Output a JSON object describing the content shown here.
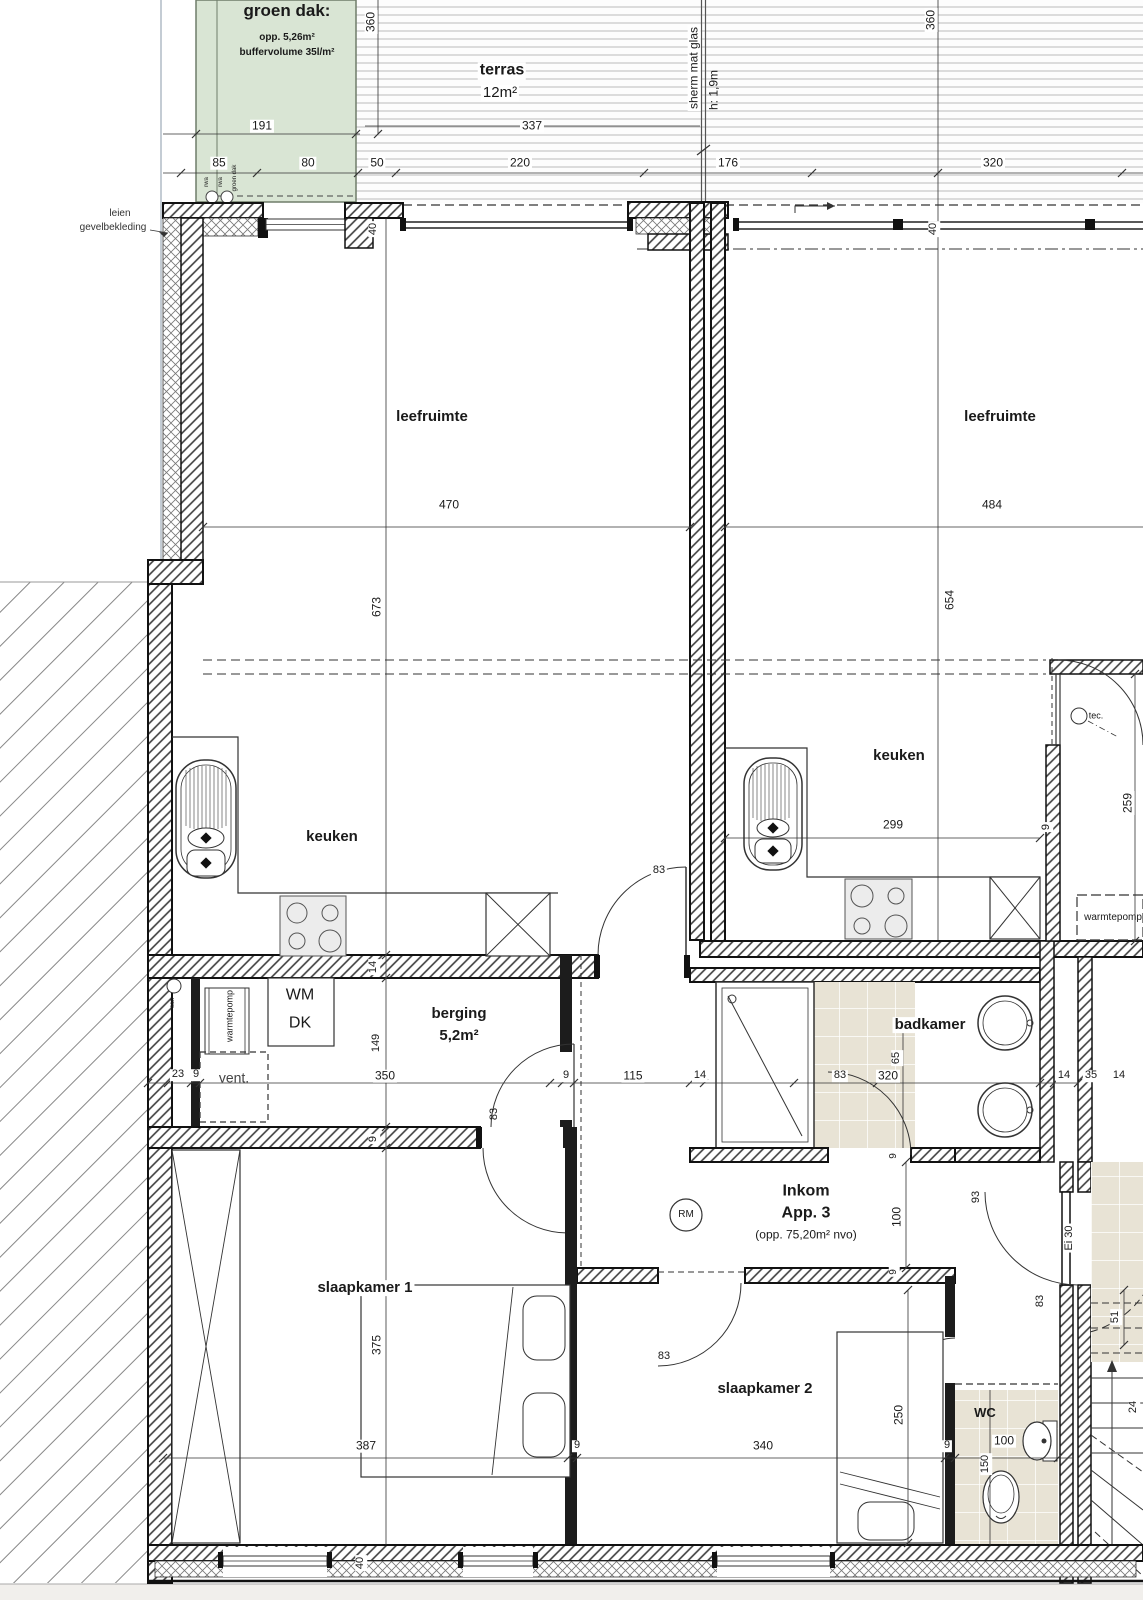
{
  "title": "floor plan apartment 3",
  "colors": {
    "green_roof": "#d9e5d4",
    "green_roof_border": "#6f7d6a",
    "tile_floor": "#e8e3d5",
    "wall_line": "#111111",
    "dim_line": "#333333",
    "page_margin": "#f1efec"
  },
  "rooms": {
    "groen_dak": {
      "title": "groen dak:",
      "line1": "opp. 5,26m²",
      "line2": "buffervolume 35l/m²"
    },
    "terras": {
      "title": "terras",
      "area": "12m²"
    },
    "leefruimte_left": "leefruimte",
    "leefruimte_right": "leefruimte",
    "keuken_left": "keuken",
    "keuken_right": "keuken",
    "berging": {
      "title": "berging",
      "area": "5,2m²"
    },
    "badkamer": "badkamer",
    "inkom": {
      "line1": "Inkom",
      "line2": "App. 3",
      "line3": "(opp. 75,20m² nvo)"
    },
    "slaapkamer1": "slaapkamer 1",
    "slaapkamer2": "slaapkamer 2",
    "wc": "WC",
    "tec": "tec.",
    "warmtepomp_right": "warmtepomp",
    "warmtepomp_left": "warmtepomp",
    "vent": "vent.",
    "san": "san",
    "wm": "WM",
    "dk": "DK",
    "rm": "RM",
    "ei30": "Ei 30"
  },
  "annotations": {
    "facade": [
      "leien",
      "gevelbekleding"
    ],
    "screen": [
      "sherm mat glas",
      "h: 1,9m"
    ],
    "roof_drains": [
      "rwa",
      "rwa",
      "groen dak"
    ]
  },
  "labels": [
    {
      "n": "room-groendak-title",
      "t": "groen dak:",
      "x": 287,
      "y": 11,
      "s": 17,
      "b": true
    },
    {
      "n": "room-groendak-opp",
      "t": "opp. 5,26m²",
      "x": 287,
      "y": 38,
      "s": 10,
      "b": true
    },
    {
      "n": "room-groendak-buffer",
      "t": "buffervolume 35l/m²",
      "x": 287,
      "y": 53,
      "s": 10,
      "b": true
    },
    {
      "n": "room-terras-title",
      "t": "terras",
      "x": 502,
      "y": 71,
      "s": 16,
      "b": true,
      "bg": true
    },
    {
      "n": "room-terras-area",
      "t": "12m²",
      "x": 500,
      "y": 93,
      "s": 15,
      "bg": true
    },
    {
      "n": "dim-191",
      "t": "191",
      "x": 262,
      "y": 126,
      "s": 12,
      "bg": true
    },
    {
      "n": "dim-360-left",
      "t": "360",
      "x": 371,
      "y": 22,
      "s": 12,
      "bg": true,
      "r": true
    },
    {
      "n": "dim-337",
      "t": "337",
      "x": 532,
      "y": 126,
      "s": 12,
      "bg": true
    },
    {
      "n": "note-sherm",
      "t": "sherm mat glas",
      "x": 694,
      "y": 68,
      "s": 12,
      "r": true,
      "bg": true
    },
    {
      "n": "note-sherm-h",
      "t": "h: 1,9m",
      "x": 714,
      "y": 90,
      "s": 12,
      "r": true
    },
    {
      "n": "dim-360-right",
      "t": "360",
      "x": 931,
      "y": 20,
      "s": 12,
      "bg": true,
      "r": true
    },
    {
      "n": "dim-85",
      "t": "85",
      "x": 219,
      "y": 163,
      "s": 12,
      "bg": true
    },
    {
      "n": "dim-80",
      "t": "80",
      "x": 308,
      "y": 163,
      "s": 12,
      "bg": true
    },
    {
      "n": "dim-50",
      "t": "50",
      "x": 377,
      "y": 163,
      "s": 12,
      "bg": true
    },
    {
      "n": "dim-220",
      "t": "220",
      "x": 520,
      "y": 163,
      "s": 12,
      "bg": true
    },
    {
      "n": "dim-176",
      "t": "176",
      "x": 728,
      "y": 163,
      "s": 12,
      "bg": true
    },
    {
      "n": "dim-320-terras",
      "t": "320",
      "x": 993,
      "y": 163,
      "s": 12,
      "bg": true
    },
    {
      "n": "note-rwa-1",
      "t": "rwa",
      "x": 207,
      "y": 182,
      "s": 6,
      "r": true
    },
    {
      "n": "note-rwa-2",
      "t": "rwa",
      "x": 221,
      "y": 182,
      "s": 6,
      "r": true
    },
    {
      "n": "note-rwa-groendak",
      "t": "groen dak",
      "x": 235,
      "y": 178,
      "s": 6,
      "r": true
    },
    {
      "n": "note-leien",
      "t": "leien",
      "x": 120,
      "y": 214,
      "s": 10,
      "c": "#333"
    },
    {
      "n": "note-gevelbekleding",
      "t": "gevelbekleding",
      "x": 113,
      "y": 228,
      "s": 10,
      "c": "#333"
    },
    {
      "n": "dim-40-topleft",
      "t": "40",
      "x": 374,
      "y": 229,
      "s": 11,
      "bg": true,
      "r": true
    },
    {
      "n": "dim-40-topright",
      "t": "40",
      "x": 934,
      "y": 229,
      "s": 11,
      "bg": true,
      "r": true
    },
    {
      "n": "room-leefruimte-left",
      "t": "leefruimte",
      "x": 432,
      "y": 417,
      "s": 15,
      "b": true
    },
    {
      "n": "room-leefruimte-right",
      "t": "leefruimte",
      "x": 1000,
      "y": 417,
      "s": 15,
      "b": true
    },
    {
      "n": "dim-470",
      "t": "470",
      "x": 449,
      "y": 505,
      "s": 12,
      "bg": true
    },
    {
      "n": "dim-484",
      "t": "484",
      "x": 992,
      "y": 505,
      "s": 12,
      "bg": true
    },
    {
      "n": "dim-673",
      "t": "673",
      "x": 377,
      "y": 607,
      "s": 12,
      "bg": true,
      "r": true
    },
    {
      "n": "dim-654",
      "t": "654",
      "x": 950,
      "y": 600,
      "s": 12,
      "bg": true,
      "r": true
    },
    {
      "n": "room-keuken-left",
      "t": "keuken",
      "x": 332,
      "y": 837,
      "s": 15,
      "b": true
    },
    {
      "n": "room-keuken-right",
      "t": "keuken",
      "x": 899,
      "y": 756,
      "s": 15,
      "b": true
    },
    {
      "n": "dim-299",
      "t": "299",
      "x": 893,
      "y": 825,
      "s": 12,
      "bg": true
    },
    {
      "n": "dim-9-keukenwall",
      "t": "9",
      "x": 1047,
      "y": 827,
      "s": 11,
      "bg": true,
      "r": true
    },
    {
      "n": "dim-259",
      "t": "259",
      "x": 1128,
      "y": 803,
      "s": 12,
      "bg": true,
      "r": true
    },
    {
      "n": "room-tec",
      "t": "tec.",
      "x": 1096,
      "y": 716,
      "s": 9
    },
    {
      "n": "room-warmtepomp-right",
      "t": "warmtepomp",
      "x": 1113,
      "y": 918,
      "s": 10
    },
    {
      "n": "dim-83-keukendoor",
      "t": "83",
      "x": 659,
      "y": 871,
      "s": 11,
      "bg": true
    },
    {
      "n": "dim-14-wall",
      "t": "14",
      "x": 374,
      "y": 967,
      "s": 11,
      "bg": true,
      "r": true
    },
    {
      "n": "note-wm",
      "t": "WM",
      "x": 300,
      "y": 996,
      "s": 16
    },
    {
      "n": "note-dk",
      "t": "DK",
      "x": 300,
      "y": 1024,
      "s": 16
    },
    {
      "n": "note-warmtepomp-left",
      "t": "warmtepomp",
      "x": 230,
      "y": 1016,
      "s": 9,
      "r": true
    },
    {
      "n": "note-vent",
      "t": "vent.",
      "x": 234,
      "y": 1078,
      "s": 14,
      "c": "#444"
    },
    {
      "n": "note-san",
      "t": "san",
      "x": 173,
      "y": 1003,
      "s": 6,
      "r": true
    },
    {
      "n": "room-berging-title",
      "t": "berging",
      "x": 459,
      "y": 1014,
      "s": 15,
      "b": true
    },
    {
      "n": "room-berging-area",
      "t": "5,2m²",
      "x": 459,
      "y": 1036,
      "s": 15,
      "b": true
    },
    {
      "n": "room-badkamer",
      "t": "badkamer",
      "x": 930,
      "y": 1025,
      "s": 15,
      "b": true,
      "bg": true
    },
    {
      "n": "dim-23",
      "t": "23",
      "x": 178,
      "y": 1075,
      "s": 11,
      "bg": true
    },
    {
      "n": "dim-9-a",
      "t": "9",
      "x": 196,
      "y": 1075,
      "s": 11,
      "bg": true
    },
    {
      "n": "dim-350",
      "t": "350",
      "x": 385,
      "y": 1076,
      "s": 12,
      "bg": true
    },
    {
      "n": "dim-149",
      "t": "149",
      "x": 377,
      "y": 1043,
      "s": 11,
      "bg": true,
      "r": true
    },
    {
      "n": "dim-9-b",
      "t": "9",
      "x": 566,
      "y": 1076,
      "s": 11,
      "bg": true
    },
    {
      "n": "dim-115",
      "t": "115",
      "x": 633,
      "y": 1076,
      "s": 12,
      "bg": true
    },
    {
      "n": "dim-14-b",
      "t": "14",
      "x": 700,
      "y": 1076,
      "s": 11,
      "bg": true
    },
    {
      "n": "dim-83-bad",
      "t": "83",
      "x": 840,
      "y": 1076,
      "s": 11,
      "bg": true
    },
    {
      "n": "dim-320-bad",
      "t": "320",
      "x": 888,
      "y": 1076,
      "s": 12,
      "bg": true
    },
    {
      "n": "dim-65",
      "t": "65",
      "x": 897,
      "y": 1058,
      "s": 11,
      "bg": true,
      "r": true
    },
    {
      "n": "dim-14-c",
      "t": "14",
      "x": 1064,
      "y": 1076,
      "s": 11,
      "bg": true
    },
    {
      "n": "dim-35",
      "t": "35",
      "x": 1091,
      "y": 1076,
      "s": 11,
      "bg": true
    },
    {
      "n": "dim-14-d",
      "t": "14",
      "x": 1119,
      "y": 1076,
      "s": 11,
      "bg": true
    },
    {
      "n": "dim-83-berging",
      "t": "83",
      "x": 495,
      "y": 1114,
      "s": 11,
      "r": true
    },
    {
      "n": "dim-9-c",
      "t": "9",
      "x": 374,
      "y": 1139,
      "s": 11,
      "bg": true,
      "r": true
    },
    {
      "n": "note-rm",
      "t": "RM",
      "x": 686,
      "y": 1215,
      "s": 10
    },
    {
      "n": "room-inkom-1",
      "t": "Inkom",
      "x": 806,
      "y": 1192,
      "s": 16,
      "b": true
    },
    {
      "n": "room-inkom-2",
      "t": "App. 3",
      "x": 806,
      "y": 1214,
      "s": 16,
      "b": true
    },
    {
      "n": "room-inkom-3",
      "t": "(opp. 75,20m² nvo)",
      "x": 806,
      "y": 1235,
      "s": 12
    },
    {
      "n": "dim-100-inkom",
      "t": "100",
      "x": 897,
      "y": 1217,
      "s": 12,
      "bg": true,
      "r": true
    },
    {
      "n": "dim-9-d",
      "t": "9",
      "x": 894,
      "y": 1156,
      "s": 10,
      "bg": true,
      "r": true
    },
    {
      "n": "dim-9-e",
      "t": "9",
      "x": 894,
      "y": 1272,
      "s": 10,
      "bg": true,
      "r": true
    },
    {
      "n": "dim-93",
      "t": "93",
      "x": 977,
      "y": 1197,
      "s": 11,
      "bg": true,
      "r": true
    },
    {
      "n": "note-ei30",
      "t": "Ei 30",
      "x": 1070,
      "y": 1238,
      "s": 11,
      "bg": true,
      "r": true
    },
    {
      "n": "dim-83-stair",
      "t": "83",
      "x": 1041,
      "y": 1301,
      "s": 11,
      "r": true
    },
    {
      "n": "dim-51",
      "t": "51",
      "x": 1116,
      "y": 1317,
      "s": 11,
      "bg": true,
      "r": true
    },
    {
      "n": "dim-24",
      "t": "24",
      "x": 1134,
      "y": 1407,
      "s": 11,
      "bg": true,
      "r": true
    },
    {
      "n": "room-slaapkamer1",
      "t": "slaapkamer 1",
      "x": 365,
      "y": 1288,
      "s": 15,
      "b": true,
      "bg": true
    },
    {
      "n": "dim-375",
      "t": "375",
      "x": 377,
      "y": 1345,
      "s": 12,
      "bg": true,
      "r": true
    },
    {
      "n": "dim-387",
      "t": "387",
      "x": 366,
      "y": 1446,
      "s": 12,
      "bg": true
    },
    {
      "n": "dim-9-f",
      "t": "9",
      "x": 577,
      "y": 1446,
      "s": 11,
      "bg": true
    },
    {
      "n": "room-slaapkamer2",
      "t": "slaapkamer 2",
      "x": 765,
      "y": 1389,
      "s": 15,
      "b": true,
      "bg": true
    },
    {
      "n": "dim-83-sk2",
      "t": "83",
      "x": 664,
      "y": 1357,
      "s": 11
    },
    {
      "n": "dim-340",
      "t": "340",
      "x": 763,
      "y": 1446,
      "s": 12,
      "bg": true
    },
    {
      "n": "dim-250",
      "t": "250",
      "x": 899,
      "y": 1415,
      "s": 12,
      "bg": true,
      "r": true
    },
    {
      "n": "dim-9-g",
      "t": "9",
      "x": 947,
      "y": 1446,
      "s": 11,
      "bg": true
    },
    {
      "n": "room-wc",
      "t": "WC",
      "x": 985,
      "y": 1413,
      "s": 13,
      "b": true
    },
    {
      "n": "dim-100-wc",
      "t": "100",
      "x": 1004,
      "y": 1441,
      "s": 12,
      "bg": true
    },
    {
      "n": "dim-150",
      "t": "150",
      "x": 986,
      "y": 1464,
      "s": 11,
      "bg": true,
      "r": true
    },
    {
      "n": "dim-40-bottom",
      "t": "40",
      "x": 361,
      "y": 1563,
      "s": 11,
      "bg": true,
      "r": true
    }
  ]
}
